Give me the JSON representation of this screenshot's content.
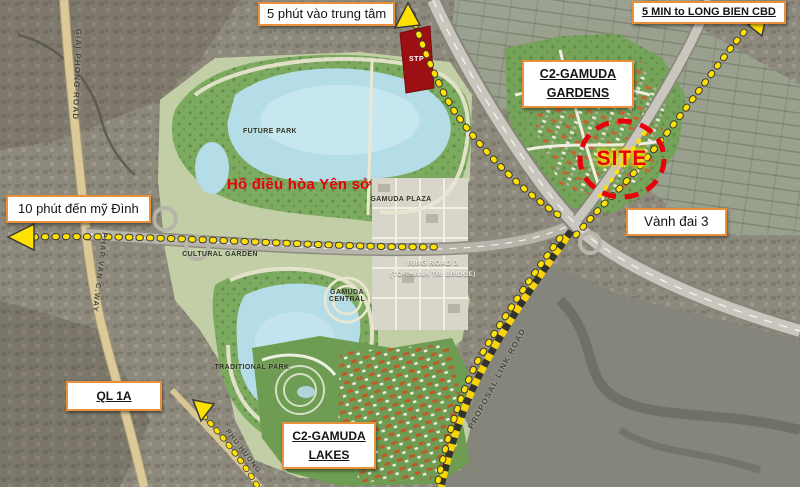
{
  "map": {
    "title": "Gamuda City location map",
    "callouts": {
      "to_center": "5 phút vào trung tâm",
      "to_long_bien": "5 MIN to LONG BIEN CBD",
      "gardens": "C2-GAMUDA GARDENS",
      "ring_road_name": "Vành đai 3",
      "to_my_dinh": "10 phút đến mỹ Đình",
      "highway_ql1a": "QL 1A",
      "lakes": "C2-GAMUDA LAKES"
    },
    "site": {
      "label": "SITE"
    },
    "stp": {
      "label": "STP"
    },
    "lake_name": "Hồ điều hòa Yên sở",
    "road_labels": {
      "giai_phong": "GIAI PHONG ROAD",
      "phap_van": "PHAP VAN C.WAY",
      "ring_road3_line1": "RING ROAD 3",
      "ring_road3_line2": "(TO THANH TRI BRIDGE)",
      "proposal_link": "PROPOSAL LINK ROAD",
      "phu_huong": "PHU HUONG"
    },
    "park_labels": {
      "future_park": "FUTURE PARK",
      "cultural_garden": "CULTURAL GARDEN",
      "gamuda_plaza": "GAMUDA PLAZA",
      "gamuda_central": "GAMUDA CENTRAL",
      "traditional_park": "TRADITIONAL PARK"
    },
    "colors": {
      "callout_border": "#e8913a",
      "route_yellow": "#ffe100",
      "site_red": "#e8000d",
      "stp_red": "#9c1013",
      "lake_blue": "#b5dde8",
      "park_green": "#7cab60"
    }
  }
}
